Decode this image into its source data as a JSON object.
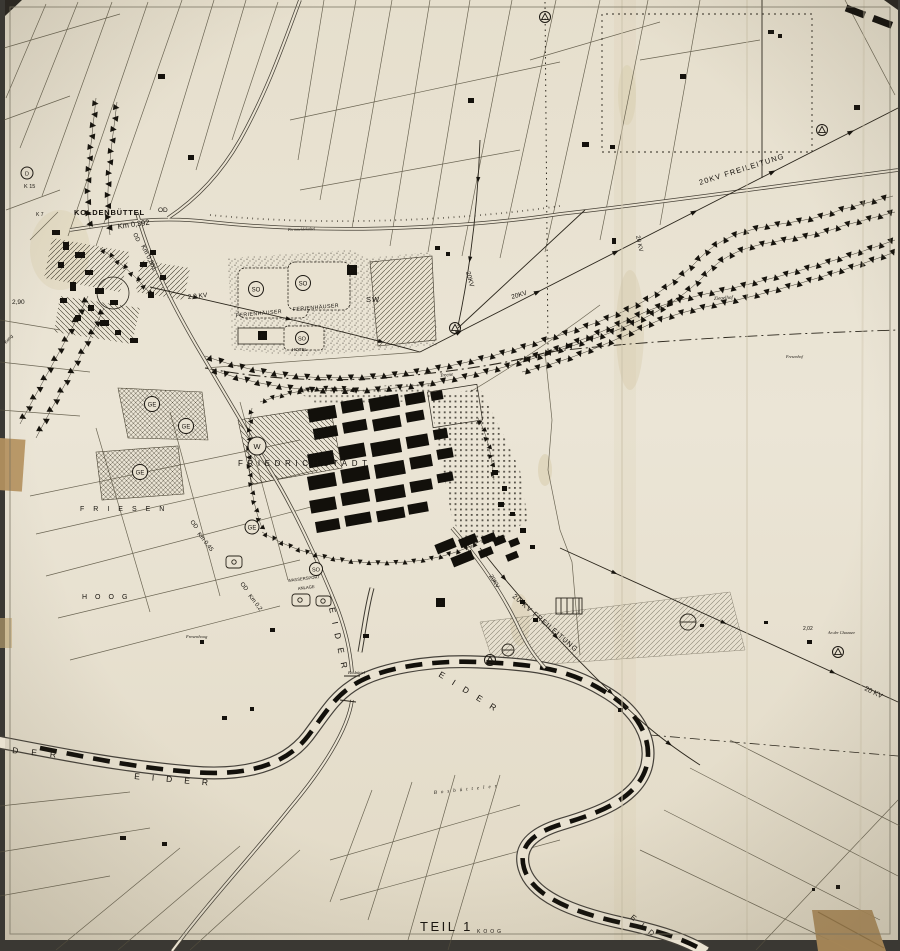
{
  "labels": {
    "koldenbuettel": "KOLDENBÜTTEL",
    "od": "OD",
    "km_0392": "Km 0,392",
    "km_0861": "Km 0,861",
    "km_045": "Km 0,45",
    "km_02": "Km 0,2",
    "fernmeldekabel": "Fernmeldekabel",
    "friedrichstadt": "FRIEDRICHSTADT",
    "ferienhaeuser": "FERIENHÄUSER",
    "hotel": "HOTEL",
    "wassersport": "WASSERSPORT",
    "anlage": "ANLAGE",
    "friesen": "FRIESEN",
    "hoog": "HOOG",
    "fresenhoog": "Fresenhoog",
    "ziegelhof": "Ziegelhof",
    "fresenhof": "Fresenhof",
    "boesbuettel": "Bösbüttel",
    "bosbuetteler": "Bosbütteler",
    "an_der_chaussee": "An der Chaussee",
    "treene": "Treene",
    "teil1": "TEIL 1",
    "koog": "KOOG",
    "koog2": "Koog",
    "der": "DER",
    "eider": "EIDER",
    "eid": "EID",
    "freileitung": "20KV FREILEITUNG",
    "freileitung2": "20 KV FREILEITUNG",
    "kv20": "20 KV",
    "kv20b": "20KV",
    "kv20c": "2,0 KV",
    "h_290": "2,90",
    "n_202": "2,02",
    "k15": "K 15",
    "k7": "K 7"
  },
  "symbols": {
    "so": "SO",
    "ge": "GE",
    "w": "W",
    "sw": "SW",
    "p": "P",
    "d": "D"
  },
  "colors": {
    "paper": "#e9e2d1",
    "ink": "#1c1812",
    "heavy": "#12100b",
    "tape": "#b5925f"
  }
}
